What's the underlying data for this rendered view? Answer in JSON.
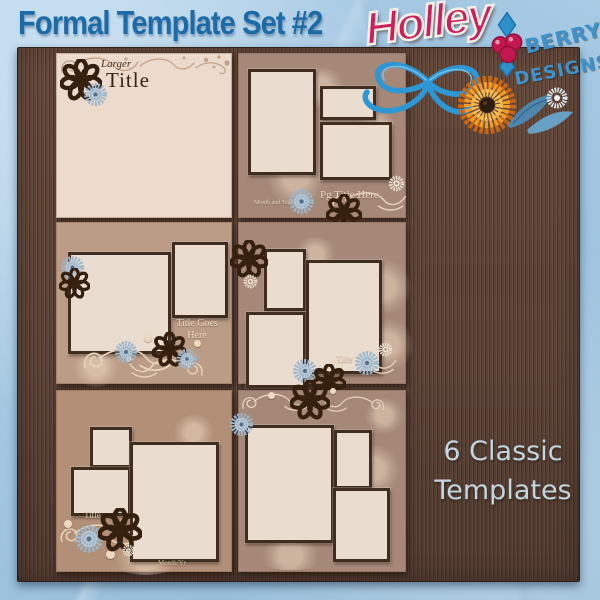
{
  "header": {
    "title": "Formal Template Set #2"
  },
  "logo": {
    "name": "Holley",
    "line1": "BERRY",
    "line2": "DESIGNS"
  },
  "tagline": {
    "line1": "6 Classic",
    "line2": "Templates"
  },
  "templates": [
    {
      "photo_slots": 0,
      "labels": {
        "accent": "Larger",
        "title": "Title"
      }
    },
    {
      "photo_slots": 3,
      "labels": {
        "title": "Pg Title Here",
        "caption": "Month and Year"
      }
    },
    {
      "photo_slots": 2,
      "labels": {
        "title_line1": "Title Goes",
        "title_line2": "Here"
      }
    },
    {
      "photo_slots": 3,
      "labels": {
        "title": "Title"
      }
    },
    {
      "photo_slots": 3,
      "labels": {
        "title": "Title",
        "caption": "Month/Yr"
      }
    },
    {
      "photo_slots": 3,
      "labels": {}
    }
  ],
  "colors": {
    "background_blue": "#a6c9e2",
    "title_blue": "#1d6ba6",
    "wood_brown": "#5b4338",
    "page_cream": "#ecdbcc",
    "page_taupe": "#a58878",
    "page_tan": "#bb9c87",
    "frame_border": "#3f2d20",
    "holley_pink": "#cb1e5d",
    "berry_blue": "#3e93cc",
    "tagline_blue": "#c2d6df"
  }
}
